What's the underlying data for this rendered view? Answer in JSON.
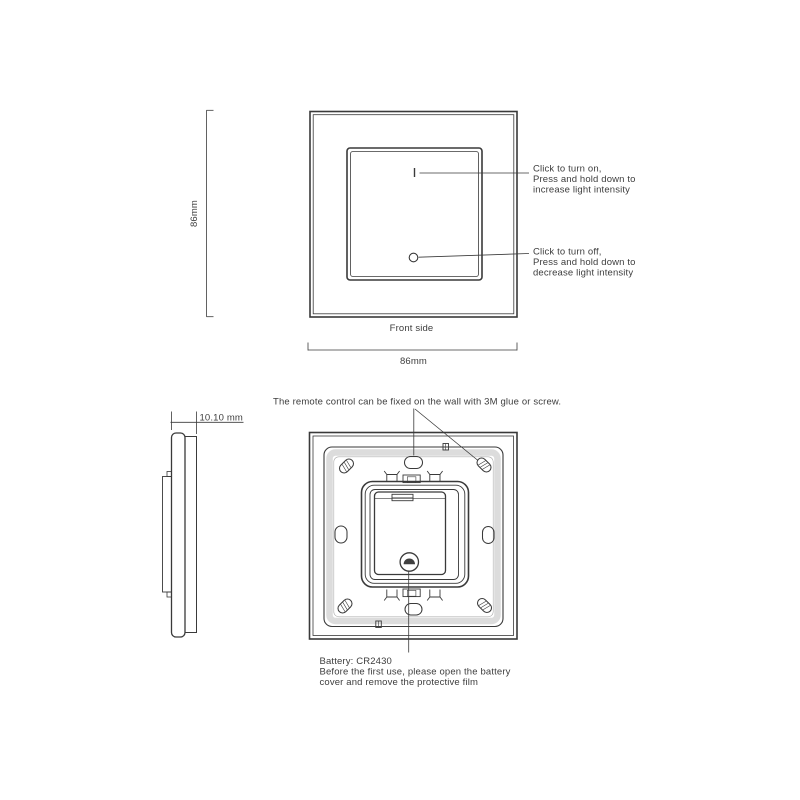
{
  "front_view": {
    "label": "Front side",
    "height_dim": "86mm",
    "width_dim": "86mm",
    "on_note": {
      "lines": [
        "Click to turn on,",
        "Press and hold down to",
        "increase light intensity"
      ]
    },
    "off_note": {
      "lines": [
        "Click to turn off,",
        "Press and hold down to",
        "decrease light intensity"
      ]
    }
  },
  "side_view": {
    "thickness_dim": "10.10 mm"
  },
  "back_view": {
    "mount_note": "The remote control can be fixed on the wall with 3M glue or screw.",
    "battery_note": {
      "lines": [
        "Battery: CR2430",
        "Before the first use, please open the battery",
        "cover and remove the protective film"
      ]
    }
  },
  "colors": {
    "line": "#3a3a3a",
    "text": "#3d3d3d",
    "shade": "#dcdcdc",
    "background": "#ffffff"
  }
}
